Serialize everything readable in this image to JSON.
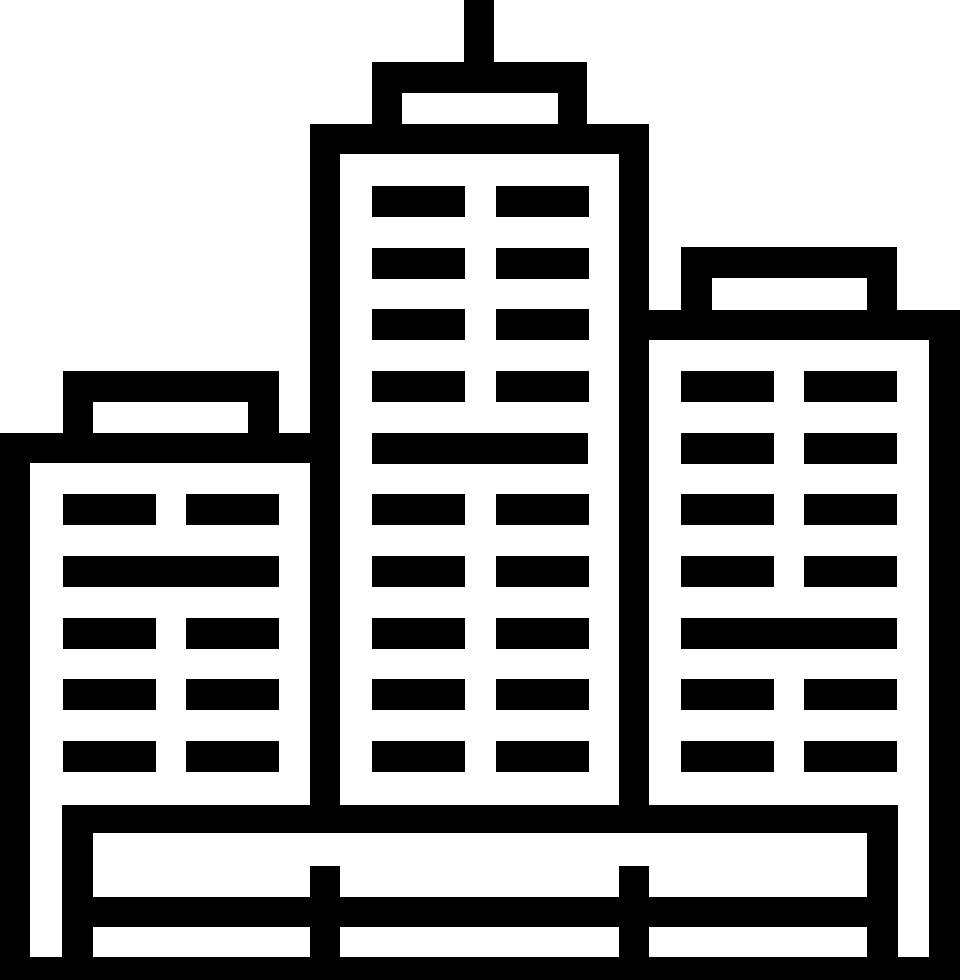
{
  "canvas": {
    "width": 960,
    "height": 980,
    "background": "#ffffff",
    "ink": "#000000"
  },
  "icon": {
    "name": "city-buildings-icon",
    "description": "Black outline cityscape glyph: three buildings with window grids, center tower with rooftop antenna, fenced base and ground line"
  },
  "structure_rects": [
    {
      "name": "antenna",
      "x": 464,
      "y": 0,
      "w": 30,
      "h": 62
    },
    {
      "name": "center-roof-box",
      "x": 372,
      "y": 62,
      "w": 215,
      "h": 62
    },
    {
      "name": "center-top-band",
      "x": 310,
      "y": 124,
      "w": 338,
      "h": 30
    },
    {
      "name": "center-left-wall",
      "x": 310,
      "y": 124,
      "w": 30,
      "h": 709
    },
    {
      "name": "center-right-wall",
      "x": 619,
      "y": 124,
      "w": 30,
      "h": 709
    },
    {
      "name": "left-roof-box",
      "x": 63,
      "y": 371,
      "w": 216,
      "h": 62
    },
    {
      "name": "left-top-band",
      "x": 0,
      "y": 433,
      "w": 340,
      "h": 30
    },
    {
      "name": "left-outer-wall",
      "x": 0,
      "y": 433,
      "w": 30,
      "h": 547
    },
    {
      "name": "right-roof-box",
      "x": 681,
      "y": 247,
      "w": 216,
      "h": 63
    },
    {
      "name": "right-top-band",
      "x": 649,
      "y": 310,
      "w": 311,
      "h": 30
    },
    {
      "name": "right-outer-wall",
      "x": 929,
      "y": 310,
      "w": 31,
      "h": 670
    },
    {
      "name": "base-band",
      "x": 62,
      "y": 805,
      "w": 836,
      "h": 28
    },
    {
      "name": "fence-left-post",
      "x": 62,
      "y": 833,
      "w": 31,
      "h": 124
    },
    {
      "name": "fence-mid-post-left",
      "x": 310,
      "y": 866,
      "w": 30,
      "h": 91
    },
    {
      "name": "fence-mid-post-right",
      "x": 619,
      "y": 866,
      "w": 30,
      "h": 91
    },
    {
      "name": "fence-right-post",
      "x": 867,
      "y": 833,
      "w": 31,
      "h": 124
    },
    {
      "name": "fence-rail",
      "x": 93,
      "y": 897,
      "w": 774,
      "h": 30
    },
    {
      "name": "ground-band",
      "x": 0,
      "y": 957,
      "w": 960,
      "h": 23
    }
  ],
  "roof_notches": [
    {
      "name": "center-roof-notch",
      "x": 402,
      "y": 93,
      "w": 156,
      "h": 31
    },
    {
      "name": "left-roof-notch",
      "x": 93,
      "y": 402,
      "w": 155,
      "h": 31
    },
    {
      "name": "right-roof-notch",
      "x": 712,
      "y": 278,
      "w": 155,
      "h": 32
    }
  ],
  "windows": {
    "window_width": 93,
    "window_height": 31,
    "merged_width": 216,
    "buildings": [
      {
        "name": "left-building",
        "cols_x": [
          63,
          186
        ],
        "rows_y": [
          494,
          556,
          618,
          679,
          741
        ],
        "merged_rows_y": [
          556
        ],
        "merged_x": 63
      },
      {
        "name": "center-building",
        "cols_x": [
          372,
          496
        ],
        "rows_y": [
          186,
          248,
          309,
          371,
          433,
          494,
          556,
          618,
          679,
          741
        ],
        "merged_rows_y": [
          433
        ],
        "merged_x": 372
      },
      {
        "name": "right-building",
        "cols_x": [
          681,
          804
        ],
        "rows_y": [
          371,
          433,
          494,
          556,
          618,
          679,
          741
        ],
        "merged_rows_y": [
          618
        ],
        "merged_x": 681
      }
    ]
  }
}
